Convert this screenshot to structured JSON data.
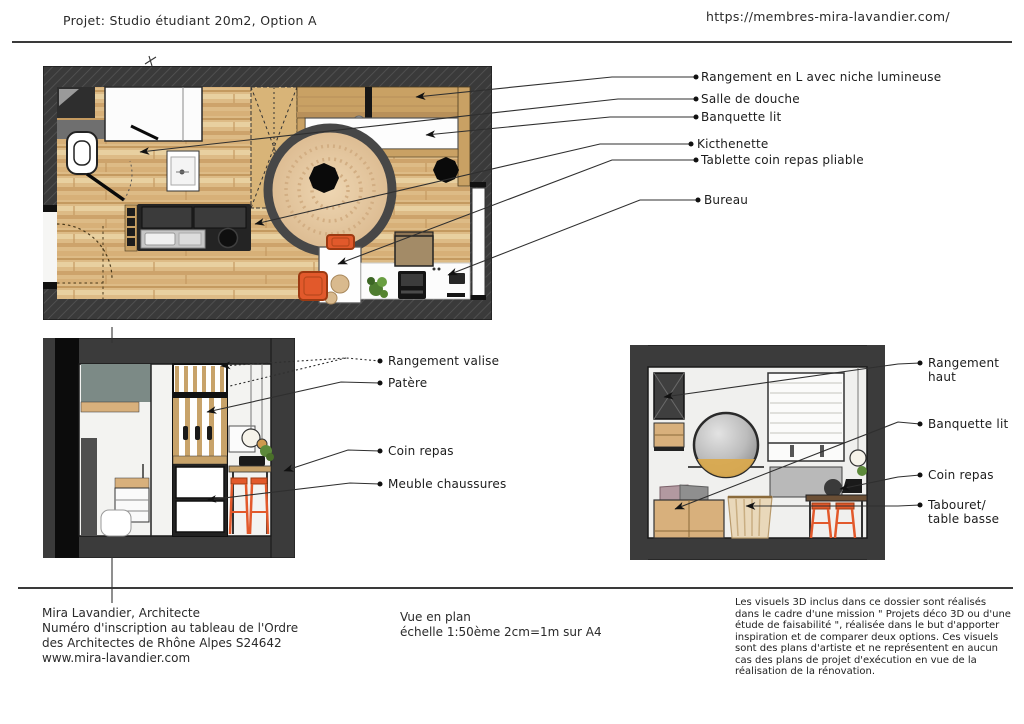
{
  "header": {
    "project_title": "Projet: Studio étudiant 20m2, Option A",
    "website": "https://membres-mira-lavandier.com/"
  },
  "plan": {
    "labels": [
      "Rangement en L avec niche lumineuse",
      "Salle de douche",
      "Banquette lit",
      "Kicthenette",
      "Tablette coin repas pliable",
      "Bureau"
    ]
  },
  "left_elevation": {
    "labels": [
      "Rangement valise",
      "Patère",
      "Coin repas",
      "Meuble chaussures"
    ]
  },
  "right_elevation": {
    "labels": [
      "Rangement haut",
      "Banquette lit",
      "Coin repas",
      "Tabouret/ table basse"
    ]
  },
  "footer": {
    "architect_line1": "Mira Lavandier, Architecte",
    "architect_line2": "Numéro d'inscription au tableau de l'Ordre",
    "architect_line3": "des Architectes de Rhône Alpes S24642",
    "architect_line4": "www.mira-lavandier.com",
    "view_title": "Vue en plan",
    "view_scale": "échelle 1:50ème 2cm=1m sur A4",
    "disclaimer": "Les visuels 3D inclus dans ce dossier sont réalisés dans le cadre d'une mission \" Projets déco 3D ou d'une étude de faisabilité \", réalisée dans le but d'apporter inspiration et de comparer deux options. Ces visuels sont des plans d'artiste et ne représentent en aucun cas des plans de projet d'exécution en vue de la réalisation de la rénovation."
  },
  "colors": {
    "wall_dark": "#3a3a3a",
    "floor_wood": "#ddbb86",
    "furniture_wood": "#c9a164",
    "accent_orange": "#e2592b",
    "rug_beige": "#e5c9a6",
    "line_black": "#2a2a2a"
  }
}
